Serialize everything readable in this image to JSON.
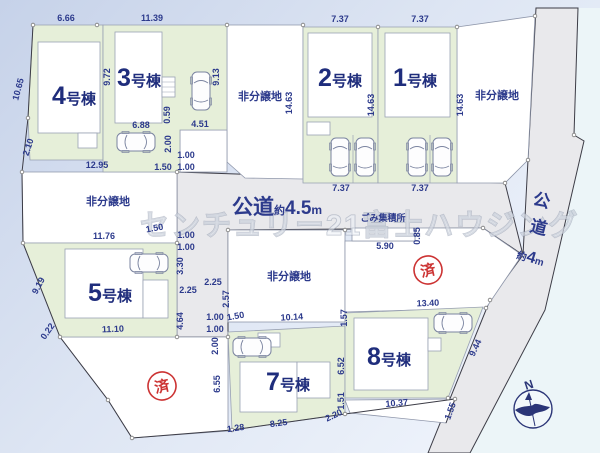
{
  "watermark": "センチュリー21富士ハウジング",
  "lots": [
    {
      "num": "4",
      "suffix": "号棟"
    },
    {
      "num": "3",
      "suffix": "号棟"
    },
    {
      "num": "2",
      "suffix": "号棟"
    },
    {
      "num": "1",
      "suffix": "号棟"
    },
    {
      "num": "5",
      "suffix": "号棟"
    },
    {
      "num": "7",
      "suffix": "号棟"
    },
    {
      "num": "8",
      "suffix": "号棟"
    }
  ],
  "labels": {
    "non_sale": "非分譲地",
    "garbage": "ごみ集積所",
    "sold": "済",
    "north": "N"
  },
  "roads": {
    "main": {
      "name": "公道",
      "approx": "約",
      "width": "4.5",
      "unit": "m"
    },
    "right": {
      "char1": "公",
      "char2": "道",
      "approx": "約",
      "width": "4",
      "unit": "m"
    }
  },
  "colors": {
    "lot_green": "#e6efd9",
    "road_gray": "#e9e9ec",
    "text_navy": "#2c3a8c",
    "sold_red": "#cc3333"
  },
  "dims": [
    "6.66",
    "11.39",
    "7.37",
    "7.37",
    "10.65",
    "2.10",
    "9.72",
    "9.13",
    "14.63",
    "14.63",
    "14.63",
    "6.88",
    "0.59",
    "4.51",
    "2.00",
    "1.00",
    "1.50",
    "1.00",
    "12.95",
    "7.37",
    "7.37",
    "11.76",
    "1.50",
    "1.00",
    "1.00",
    "3.30",
    "2.25",
    "2.25",
    "2.57",
    "4.64",
    "1.00",
    "1.00",
    "1.50",
    "2.00",
    "10.14",
    "9.19",
    "0.22",
    "11.10",
    "6.55",
    "1.28",
    "8.25",
    "2.20",
    "1.51",
    "6.52",
    "1.57",
    "13.40",
    "10.37",
    "1.55",
    "9.44",
    "5.90",
    "0.85"
  ]
}
